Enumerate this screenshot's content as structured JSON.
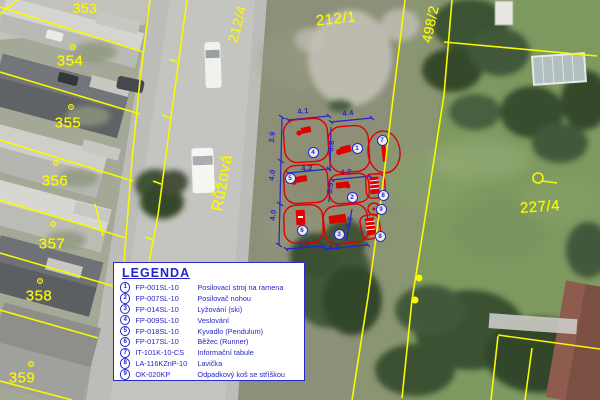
{
  "colors": {
    "parcel_yellow": "#f9f900",
    "drawing_blue": "#2525cd",
    "equipment_red": "#df0000",
    "legend_blue": "#2326c8",
    "road_gray": "#bcbcb8",
    "grass_green": "#7e9960"
  },
  "street": {
    "name": "Růžová",
    "x": 223,
    "y": 183,
    "fs": 16,
    "rot": -80
  },
  "parcels": [
    {
      "id": "353",
      "x": 85,
      "y": 8,
      "fs": 14,
      "rot": 0
    },
    {
      "id": "354",
      "x": 70,
      "y": 61,
      "fs": 15,
      "rot": 0
    },
    {
      "id": "355",
      "x": 68,
      "y": 123,
      "fs": 15,
      "rot": 0
    },
    {
      "id": "356",
      "x": 55,
      "y": 181,
      "fs": 15,
      "rot": 0
    },
    {
      "id": "357",
      "x": 52,
      "y": 244,
      "fs": 15,
      "rot": 0
    },
    {
      "id": "358",
      "x": 39,
      "y": 296,
      "fs": 15,
      "rot": 0
    },
    {
      "id": "359",
      "x": 22,
      "y": 378,
      "fs": 15,
      "rot": 0
    },
    {
      "id": "212/4",
      "x": 237,
      "y": 24,
      "fs": 14,
      "rot": -75
    },
    {
      "id": "212/1",
      "x": 336,
      "y": 19,
      "fs": 15,
      "rot": -6
    },
    {
      "id": "498/2",
      "x": 430,
      "y": 24,
      "fs": 14,
      "rot": -78
    },
    {
      "id": "227/4",
      "x": 540,
      "y": 207,
      "fs": 15,
      "rot": -4
    }
  ],
  "markers": [
    [
      73,
      47
    ],
    [
      71,
      107
    ],
    [
      56,
      163
    ],
    [
      53,
      224
    ],
    [
      40,
      281
    ],
    [
      31,
      364
    ]
  ],
  "boundary_dots": [
    [
      419,
      278
    ],
    [
      415,
      300
    ]
  ],
  "dims": [
    {
      "t": "4.1",
      "x": 303,
      "y": 111,
      "rot": -5
    },
    {
      "t": "4.4",
      "x": 348,
      "y": 113,
      "rot": -5
    },
    {
      "t": "3.9",
      "x": 272,
      "y": 137,
      "rot": -84
    },
    {
      "t": "3.8",
      "x": 331,
      "y": 146,
      "rot": -84
    },
    {
      "t": "4.2",
      "x": 307,
      "y": 168,
      "rot": -4
    },
    {
      "t": "4.2",
      "x": 346,
      "y": 172,
      "rot": -4
    },
    {
      "t": "4.0",
      "x": 272,
      "y": 175,
      "rot": -84
    },
    {
      "t": "3.5",
      "x": 330,
      "y": 188,
      "rot": -84
    },
    {
      "t": "4.0",
      "x": 273,
      "y": 215,
      "rot": -84
    },
    {
      "t": "3.5",
      "x": 304,
      "y": 244,
      "rot": -4
    },
    {
      "t": "4.3",
      "x": 334,
      "y": 247,
      "rot": -4
    },
    {
      "t": "3.5",
      "x": 349,
      "y": 222,
      "rot": -72
    }
  ],
  "map_items": [
    {
      "n": "1",
      "x": 356,
      "y": 147
    },
    {
      "n": "2",
      "x": 351,
      "y": 196
    },
    {
      "n": "3",
      "x": 338,
      "y": 233
    },
    {
      "n": "4",
      "x": 312,
      "y": 151
    },
    {
      "n": "5",
      "x": 289,
      "y": 177
    },
    {
      "n": "6",
      "x": 301,
      "y": 229
    },
    {
      "n": "7",
      "x": 381,
      "y": 139
    },
    {
      "n": "8",
      "x": 382,
      "y": 194
    },
    {
      "n": "9",
      "x": 380,
      "y": 208
    },
    {
      "n": "8",
      "x": 379,
      "y": 235
    }
  ],
  "legend": {
    "title": "LEGENDA",
    "items": [
      {
        "n": "1",
        "code": "FP-001SL-10",
        "desc": "Posilovací stroj na ramena"
      },
      {
        "n": "2",
        "code": "FP-007SL-10",
        "desc": "Posilovač nohou"
      },
      {
        "n": "3",
        "code": "FP-014SL-10",
        "desc": "Lyžování (ski)"
      },
      {
        "n": "4",
        "code": "FP-009SL-10",
        "desc": "Veslování"
      },
      {
        "n": "5",
        "code": "FP-018SL-10",
        "desc": "Kyvadlo (Pendulum)"
      },
      {
        "n": "6",
        "code": "FP-017SL-10",
        "desc": "Běžec (Runner)"
      },
      {
        "n": "7",
        "code": "IT-101K-10-CS",
        "desc": "Informační tabule"
      },
      {
        "n": "8",
        "code": "LA-116KZnP-10",
        "desc": "Lavička"
      },
      {
        "n": "9",
        "code": "OK-020KP",
        "desc": "Odpadkový koš se stříškou"
      }
    ]
  }
}
